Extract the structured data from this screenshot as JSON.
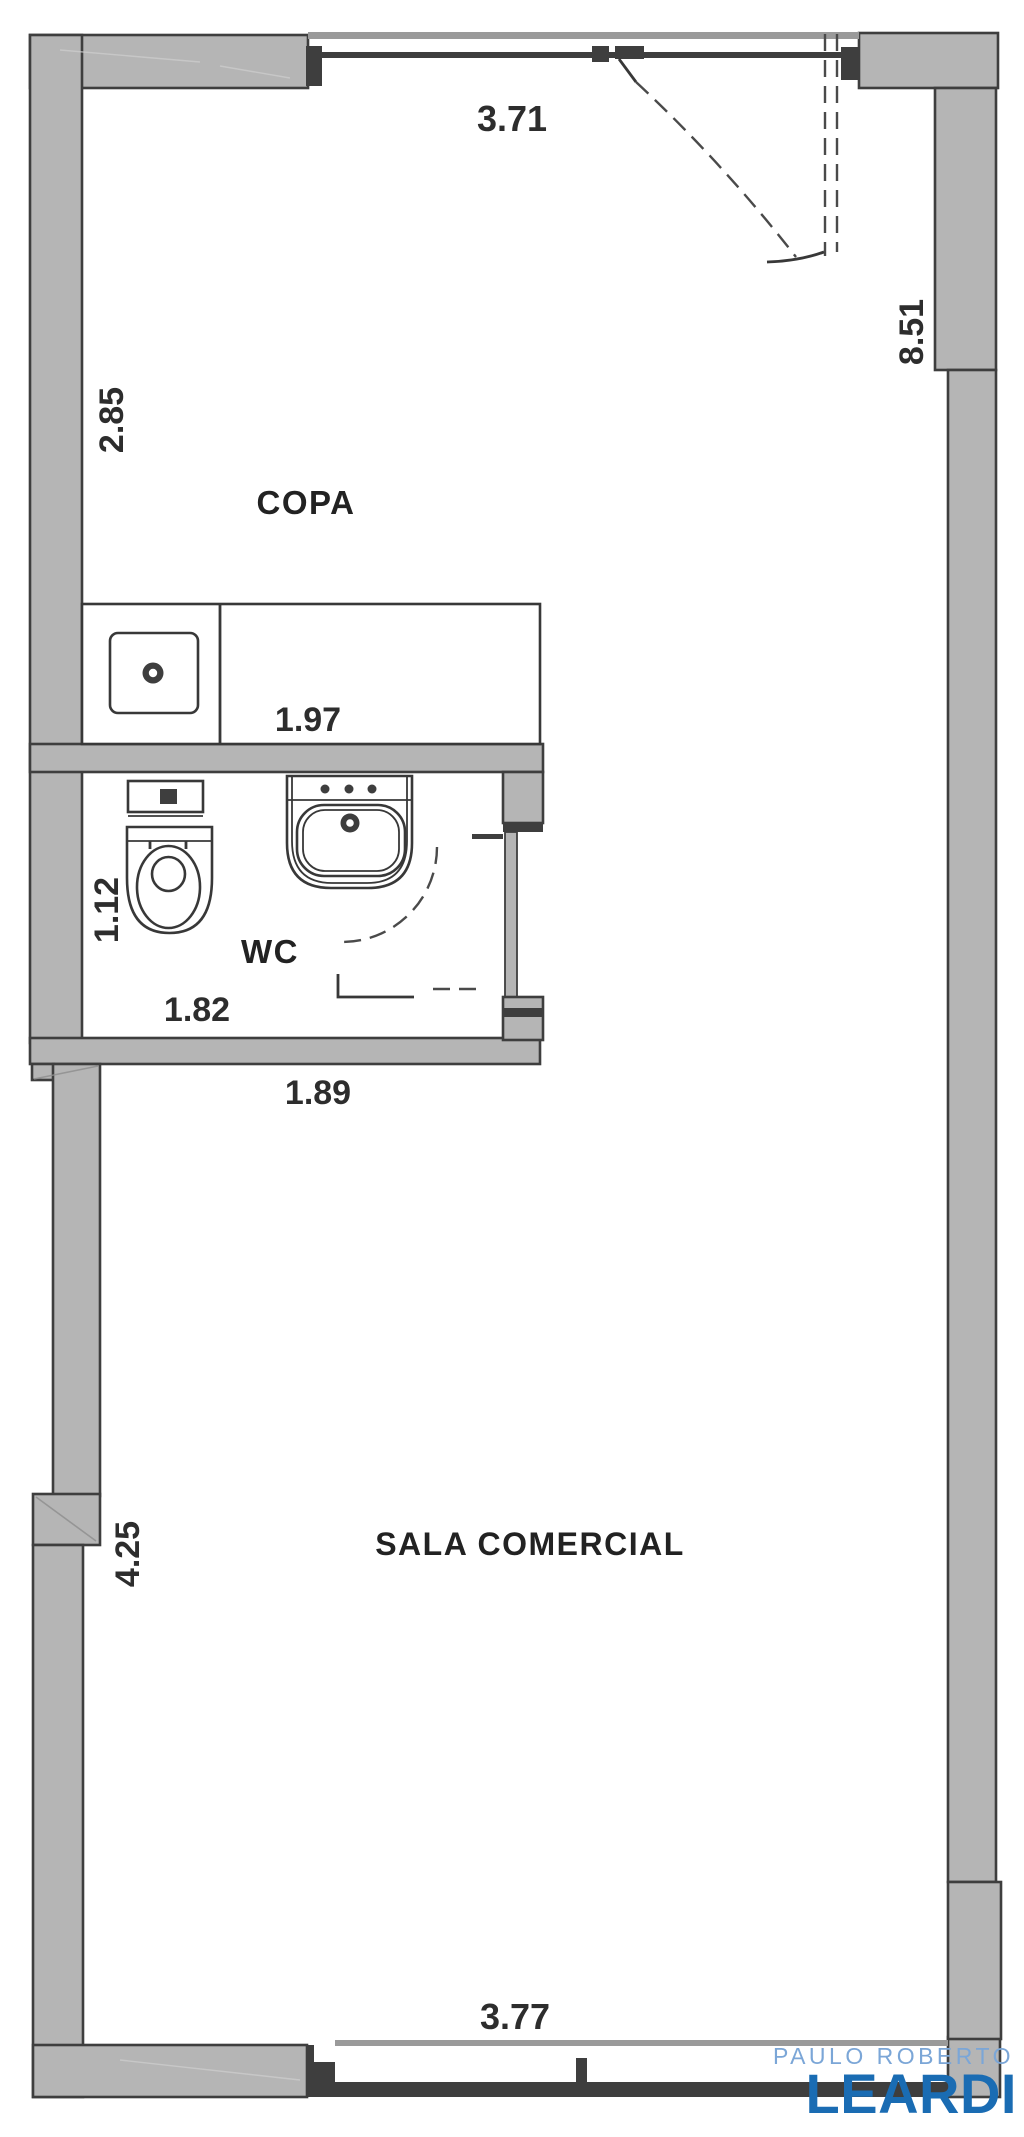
{
  "plan": {
    "rooms": {
      "copa": "COPA",
      "wc": "WC",
      "sala": "SALA COMERCIAL"
    },
    "dimensions": {
      "top": "3.71",
      "copa_left": "2.85",
      "counter": "1.97",
      "right": "8.51",
      "wc_left": "1.12",
      "wc_width": "1.82",
      "below_wc": "1.89",
      "sala_left": "4.25",
      "bottom": "3.77"
    },
    "colors": {
      "wall_fill": "#b5b5b5",
      "wall_line": "#3e3e3e",
      "window_line": "#9a9a9a",
      "fixture_line": "#383838",
      "dimension_text": "#2d2d2d"
    }
  },
  "branding": {
    "name_top": "PAULO ROBERTO",
    "name_main": "LEARDI",
    "color_top": "#7ba6d7",
    "color_main": "#1a6cb3"
  }
}
